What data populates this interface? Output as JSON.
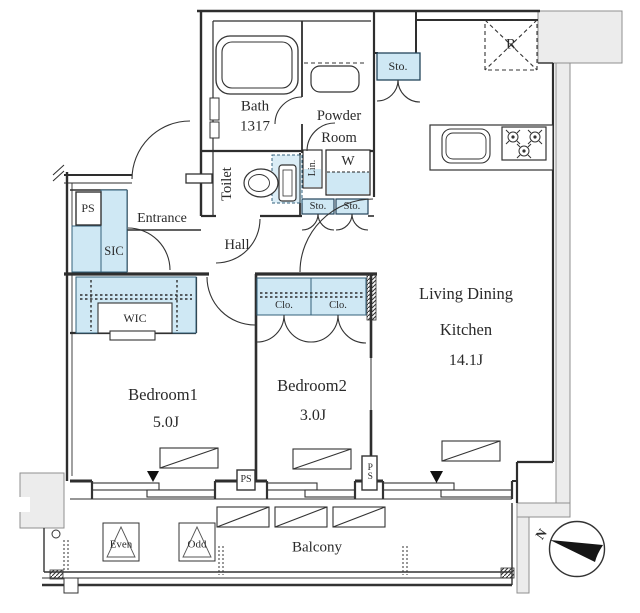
{
  "plan": {
    "colors": {
      "storage_fill": "#cfe8f4",
      "wall": "#2e2e2e",
      "exterior_fill": "#ececec"
    },
    "rooms": {
      "bath": {
        "name": "Bath",
        "size": "1317"
      },
      "powder_room": {
        "name_line1": "Powder",
        "name_line2": "Room"
      },
      "toilet": {
        "name": "Toilet"
      },
      "hall": {
        "name": "Hall"
      },
      "entrance": {
        "name": "Entrance"
      },
      "living_dining_kitchen": {
        "name_line1": "Living Dining",
        "name_line2": "Kitchen",
        "area": "14.1J"
      },
      "bedroom1": {
        "name": "Bedroom1",
        "area": "5.0J"
      },
      "bedroom2": {
        "name": "Bedroom2",
        "area": "3.0J"
      },
      "balcony": {
        "name": "Balcony"
      }
    },
    "closets": {
      "sic": "SIC",
      "wic": "WIC",
      "clo_left": "Clo.",
      "clo_right": "Clo.",
      "linen": "Lin.",
      "washer": "W",
      "sto_ldk": "Sto.",
      "sto_hall_left": "Sto.",
      "sto_hall_right": "Sto."
    },
    "equipment": {
      "fridge": "R"
    },
    "pipe_spaces": {
      "entry": "PS",
      "between_bedrooms": "PS",
      "ldk_side": "PS"
    },
    "balcony_items": {
      "even": "Even",
      "odd": "Odd"
    },
    "compass": {
      "north": "N"
    }
  }
}
